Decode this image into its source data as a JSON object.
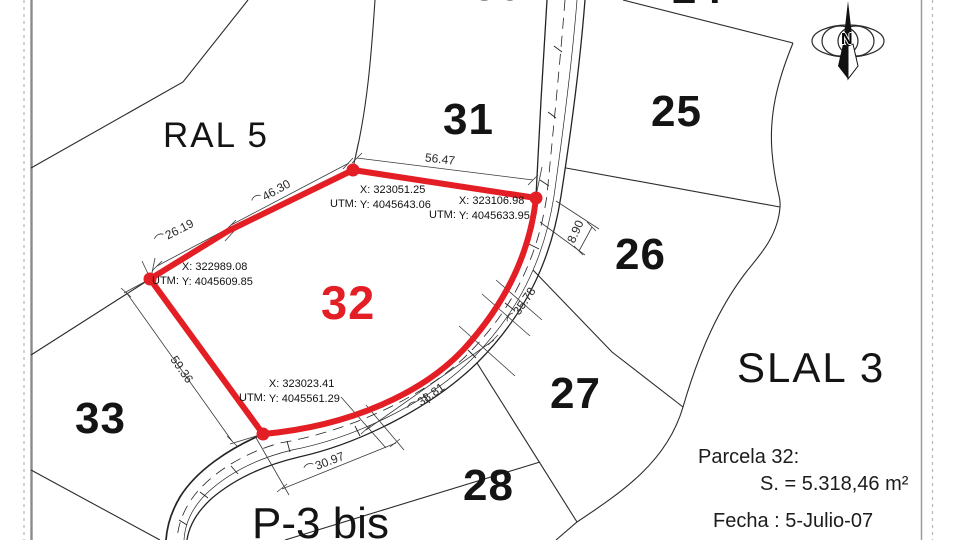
{
  "drawing": {
    "region_labels": {
      "ral5": "RAL 5",
      "slal3": "SLAL 3",
      "p3bis": "P-3 bis"
    },
    "parcel_numbers": {
      "p24": "24",
      "p25": "25",
      "p26": "26",
      "p27": "27",
      "p28": "28",
      "p30": "30",
      "p31": "31",
      "p32": "32",
      "p33": "33"
    },
    "utm_points": [
      {
        "prefix": "UTM:",
        "x": "X: 323051.25",
        "y": "Y: 4045643.06"
      },
      {
        "prefix": "UTM:",
        "x": "X: 323106.98",
        "y": "Y: 4045633.95"
      },
      {
        "prefix": "UTM:",
        "x": "X: 322989.08",
        "y": "Y: 4045609.85"
      },
      {
        "prefix": "UTM:",
        "x": "X: 323023.41",
        "y": "Y: 4045561.29"
      }
    ],
    "dimensions": [
      {
        "value": "56.47",
        "arc": ""
      },
      {
        "value": "46.30",
        "arc": "⌒"
      },
      {
        "value": "26.19",
        "arc": "⌒"
      },
      {
        "value": "8.90",
        "arc": ""
      },
      {
        "value": "59.36",
        "arc": ""
      },
      {
        "value": "38.81",
        "arc": "⌒"
      },
      {
        "value": "30.97",
        "arc": "⌒"
      },
      {
        "value": "35.78",
        "arc": "⌒"
      }
    ],
    "info_block": {
      "parcel_line": "Parcela 32:",
      "area_line": "S. = 5.318,46 m²",
      "date_line": "Fecha : 5-Julio-07"
    },
    "compass": {
      "north_label": "N"
    },
    "colors": {
      "parcel_highlight": "#e41e25",
      "linework": "#1f1f1f"
    }
  }
}
